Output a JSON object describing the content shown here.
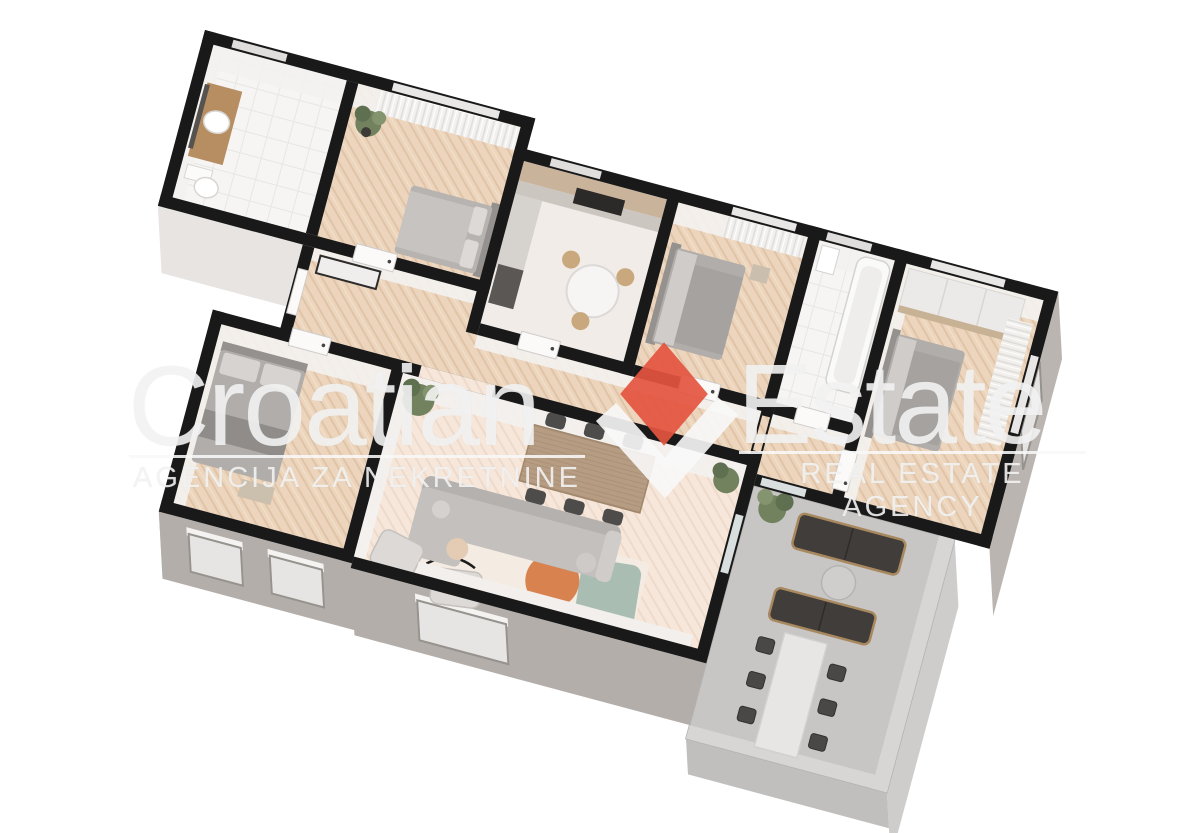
{
  "watermark": {
    "brand_left": "Croatian",
    "brand_right": "Estate",
    "tagline_left": "AGENCIJA ZA NEKRETNINE",
    "tagline_right": "REAL ESTATE AGENCY",
    "colors": {
      "diamond_red": "#e4543f",
      "check_white": "#f6f6f6",
      "text_white": "#f3f3f3"
    }
  },
  "floorplan": {
    "type": "3d-rendered-apartment-plan",
    "rooms": [
      {
        "id": "bathroom-1",
        "features": [
          "vanity",
          "sink",
          "toilet"
        ]
      },
      {
        "id": "bedroom-1",
        "features": [
          "double-bed",
          "plant",
          "curtains",
          "window"
        ]
      },
      {
        "id": "kitchen",
        "features": [
          "counter",
          "cooktop",
          "round-table",
          "chairs"
        ]
      },
      {
        "id": "bedroom-2",
        "features": [
          "double-bed",
          "curtains",
          "window"
        ]
      },
      {
        "id": "bathroom-2",
        "features": [
          "bathtub",
          "sink"
        ]
      },
      {
        "id": "bedroom-3",
        "features": [
          "wardrobe",
          "double-bed",
          "curtains",
          "window"
        ]
      },
      {
        "id": "hallway",
        "features": [
          "console",
          "doors"
        ]
      },
      {
        "id": "bedroom-4",
        "features": [
          "double-bed",
          "windows"
        ]
      },
      {
        "id": "living-dining-room",
        "features": [
          "dining-table",
          "six-chairs",
          "sectional-sofa",
          "armchairs",
          "rug",
          "plants"
        ]
      },
      {
        "id": "terrace",
        "features": [
          "outdoor-sofas",
          "coffee-table",
          "long-dining-table",
          "chairs"
        ]
      }
    ]
  }
}
